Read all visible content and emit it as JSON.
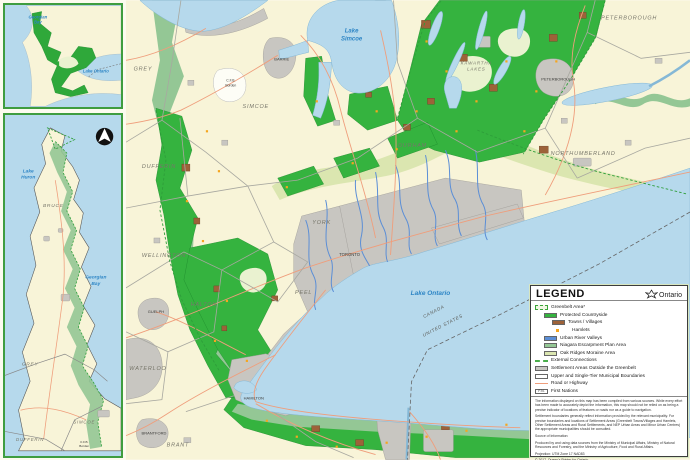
{
  "colors": {
    "land": "#f8f4d8",
    "water": "#b6d9ec",
    "protected_countryside": "#35b33f",
    "niagara_escarpment": "#94c795",
    "oak_ridges_moraine": "#dbe6b0",
    "towns_villages": "#9d6239",
    "hamlets": "#f5a61f",
    "urban_river_valleys": "#5b8ed6",
    "settlement": "#c8c6c1",
    "road": "#ef9e7c",
    "greenbelt_outline": "#2e9e3a",
    "municipal_boundary": "#a8a8a0",
    "water_label": "#2d85c5"
  },
  "insets": {
    "overview": {
      "labels": {
        "georgian_bay_1": "Georgian",
        "georgian_bay_2": "Bay",
        "lake_ontario": "Lake Ontario"
      }
    },
    "escarpment": {
      "labels": {
        "lake_huron_1": "Lake",
        "lake_huron_2": "Huron",
        "georgian_bay_1": "Georgian",
        "georgian_bay_2": "Bay",
        "bruce": "BRUCE",
        "grey": "GREY",
        "simcoe": "SIMCOE",
        "dufferin": "DUFFERIN",
        "cfb_1": "C.F.B.",
        "cfb_2": "Borden"
      }
    }
  },
  "main_map": {
    "labels": {
      "grey": "GREY",
      "simcoe": "SIMCOE",
      "dufferin": "DUFFERIN",
      "wellington": "WELLINGTON",
      "waterloo": "WATERLOO",
      "brant": "BRANT",
      "halton": "HALTON",
      "peel": "PEEL",
      "york": "YORK",
      "durham": "DURHAM",
      "kawartha_1": "KAWARTHA",
      "kawartha_2": "LAKES",
      "peterborough_county": "PETERBOROUGH",
      "northumberland": "NORTHUMBERLAND",
      "toronto": "TORONTO",
      "hamilton": "HAMILTON",
      "barrie": "BARRIE",
      "guelph": "GUELPH",
      "brantford": "BRANTFORD",
      "peterborough_city": "PETERBOROUGH",
      "cfb_1": "C.F.B.",
      "cfb_2": "Borden",
      "lake_simcoe_1": "Lake",
      "lake_simcoe_2": "Simcoe",
      "lake_ontario": "Lake Ontario",
      "canada": "CANADA",
      "united_states": "UNITED STATES"
    }
  },
  "legend": {
    "title": "LEGEND",
    "logo_text": "Ontario",
    "items": [
      {
        "label": "Greenbelt Area*"
      },
      {
        "label": "Protected Countryside"
      },
      {
        "label": "Towns / Villages"
      },
      {
        "label": "Hamlets"
      },
      {
        "label": "Urban River Valleys"
      },
      {
        "label": "Niagara Escarpment Plan Area"
      },
      {
        "label": "Oak Ridges Moraine Area"
      },
      {
        "label": "External Connections"
      },
      {
        "label": "Settlement Areas Outside the Greenbelt"
      },
      {
        "label": "Upper and Single-Tier Municipal Boundaries"
      },
      {
        "label": "Road or Highway"
      },
      {
        "label": "First Nations",
        "swatch_text": "F.N."
      }
    ],
    "notes": {
      "note1": "The information displayed on this map has been compiled from various sources. While every effort has been made to accurately depict the information, this map should not be relied on as being a precise indicator of locations of features or roads nor as a guide to navigation.",
      "note2": "Settlement boundaries generally reflect information provided by the relevant municipality. For precise boundaries and locations of Settlement Areas (Greenbelt Towns/Villages and Hamlets, Other Settlement Areas and Rural Settlements, and NEP Urban Areas and Minor Urban Centres) the appropriate municipalities should be consulted.",
      "source_heading": "Source of Information:",
      "source_body": "Produced by and using data sources from the Ministry of Municipal Affairs, Ministry of Natural Resources and Forestry, and the Ministry of Agriculture, Food and Rural Affairs.",
      "projection": "Projection: UTM Zone 17 NAD83",
      "copyright": "© 2017, Queen's Printer for Ontario"
    }
  }
}
